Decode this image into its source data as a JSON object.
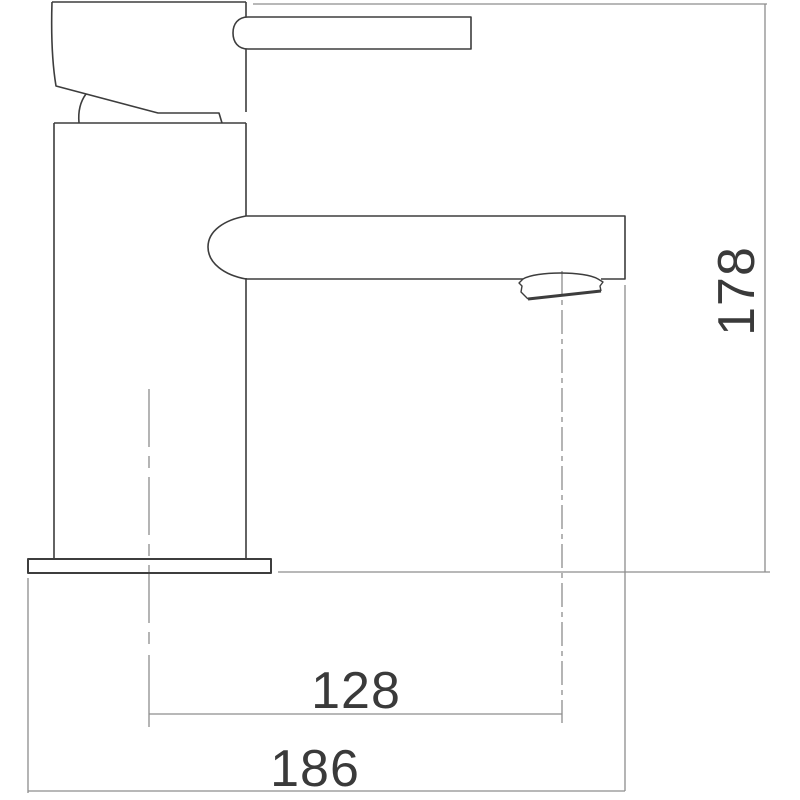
{
  "drawing": {
    "kind": "technical dimension drawing of a single-lever basin tap, side view",
    "labels": {
      "height": "178",
      "reach": "128",
      "width": "186"
    },
    "colors": {
      "outline": "#3d3d3d",
      "dimension": "#8d8d8d",
      "text": "#3a3a3a",
      "background": "#ffffff"
    }
  }
}
